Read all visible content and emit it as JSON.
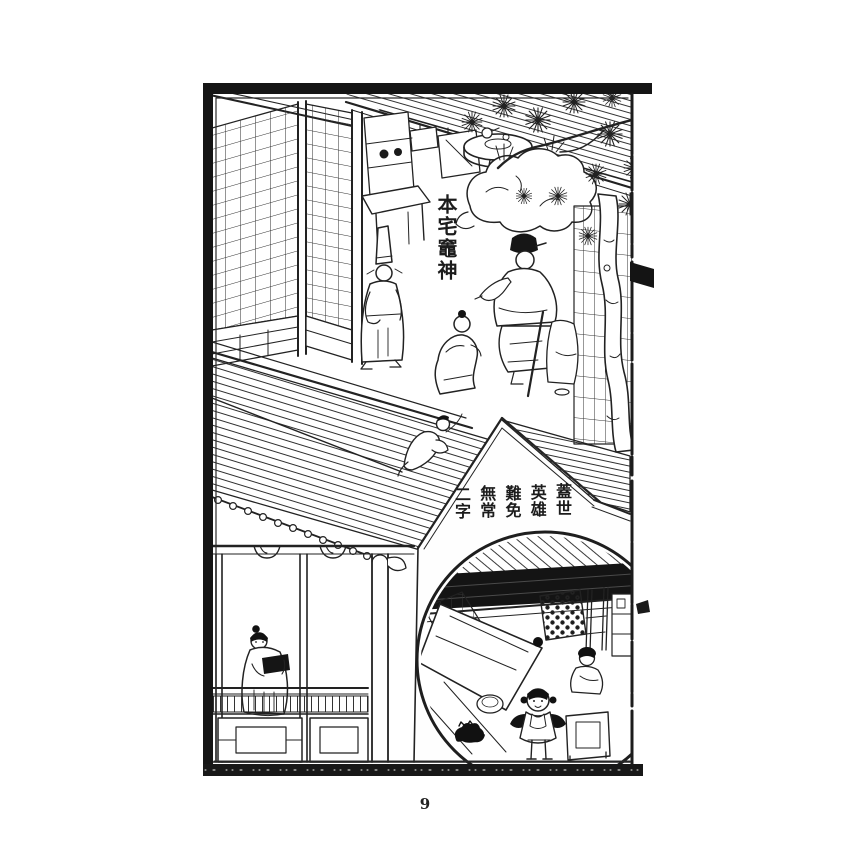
{
  "page": {
    "number": "9",
    "paper_color": "#ffffff",
    "ink_color": "#1c1c1c"
  },
  "illustration": {
    "style": "chinese-woodblock-print",
    "caption_kitchen_god": "本宅竈神",
    "gable_inscription": {
      "full": "蓋世英雄難免無常二字",
      "columns": [
        "蓋世",
        "英雄",
        "難免",
        "無常",
        "二字"
      ]
    }
  }
}
